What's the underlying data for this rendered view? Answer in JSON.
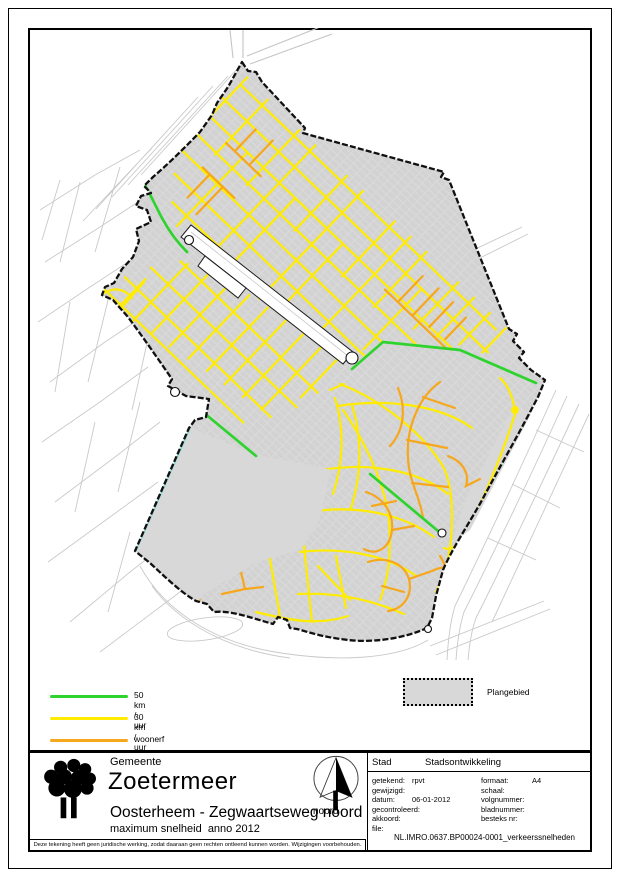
{
  "map": {
    "colors": {
      "50": "#2ed32e",
      "30": "#ffec00",
      "woonerf": "#f6a71b",
      "water": "#8fd8d2",
      "plan": "#d8d8d8",
      "boundary": "#101010"
    },
    "legend": {
      "items": [
        {
          "id": "50",
          "label": "50 km / uur"
        },
        {
          "id": "30",
          "label": "30 km / uur"
        },
        {
          "id": "woonerf",
          "label": "woonerf"
        }
      ],
      "area_label": "Plangebied"
    }
  },
  "title_block": {
    "org_prefix": "Gemeente",
    "org_name": "Zoetermeer",
    "project_title": "Oosterheem - Zegwaartseweg noord",
    "project_subtitle": "maximum snelheid  anno 2012",
    "north_label": "noord",
    "department": "Stad",
    "department2": "Stadsontwikkeling",
    "fields_left": [
      {
        "label": "getekend:",
        "value": "rpvt"
      },
      {
        "label": "gewijzigd:",
        "value": ""
      },
      {
        "label": "datum:",
        "value": "06-01-2012"
      },
      {
        "label": "gecontroleerd:",
        "value": ""
      },
      {
        "label": "akkoord:",
        "value": ""
      },
      {
        "label": "file:",
        "value": ""
      }
    ],
    "fields_right": [
      {
        "label": "formaat:",
        "value": "A4"
      },
      {
        "label": "schaal:",
        "value": ""
      },
      {
        "label": "volgnummer:",
        "value": ""
      },
      {
        "label": "bladnummer:",
        "value": ""
      },
      {
        "label": "besteks nr:",
        "value": ""
      }
    ],
    "file_value": "NL.IMRO.0637.BP00024-0001_verkeerssnelheden"
  },
  "disclaimer": "Deze tekening heeft geen juridische werking, zodat daaraan geen rechten ontleend kunnen worden. Wijzigingen voorbehouden."
}
